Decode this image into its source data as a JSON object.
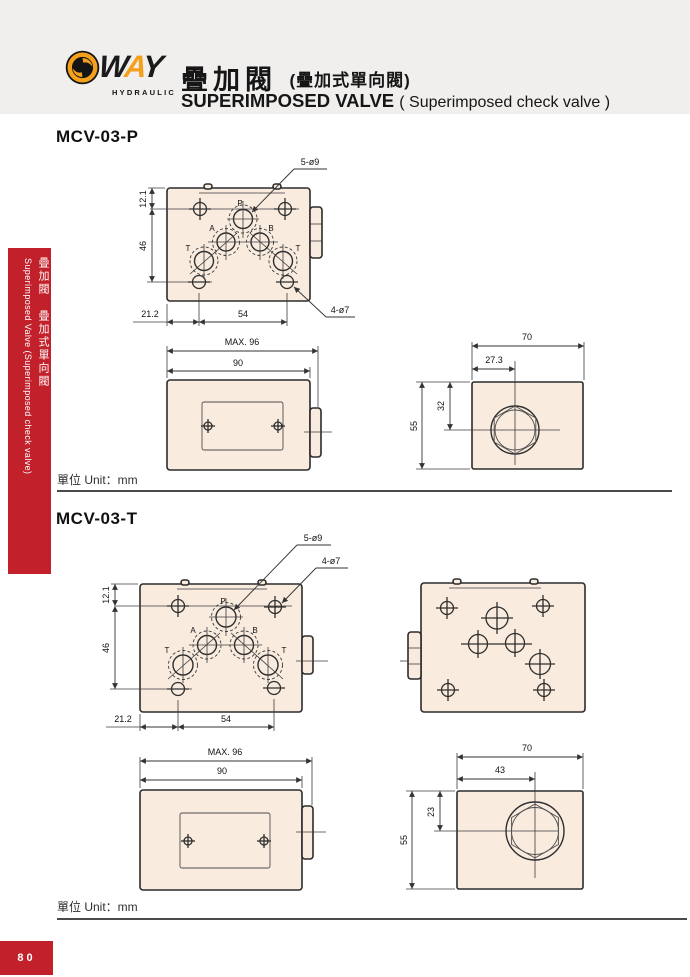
{
  "header": {
    "brand_w": "W",
    "brand_a": "A",
    "brand_y": "Y",
    "brand_sub": "HYDRAULIC",
    "title_cn": "疊加閥",
    "title_cn_note": "(疊加式單向閥)",
    "title_en": "SUPERIMPOSED VALVE",
    "title_en_note": "( Superimposed check valve )"
  },
  "sidebar": {
    "cn": "疊加閥 疊加式單向閥",
    "en": "Superimposed Valve (Superimposed check valve)"
  },
  "page_number": "80",
  "unit_label": "單位 Unit：mm",
  "colors": {
    "accent_red": "#c2202a",
    "logo_orange": "#f5a01b",
    "drawing_fill": "#f9ecdf",
    "header_gray": "#f0efed"
  },
  "mcv03p": {
    "heading": "MCV-03-P",
    "top_view": {
      "callout_5holes": "5-ø9",
      "callout_4holes": "4-ø7",
      "h_121": "12.1",
      "h_46": "46",
      "w_212": "21.2",
      "w_54": "54",
      "port_p": "P",
      "port_a": "A",
      "port_b": "B",
      "port_t1": "T",
      "port_t2": "T"
    },
    "front_view": {
      "w_max": "MAX. 96",
      "w_90": "90"
    },
    "side_view": {
      "w_70": "70",
      "w_273": "27.3",
      "h_55": "55",
      "h_32": "32"
    }
  },
  "mcv03t": {
    "heading": "MCV-03-T",
    "top_view": {
      "callout_5holes": "5-ø9",
      "callout_4holes": "4-ø7",
      "h_121": "12.1",
      "h_46": "46",
      "w_212": "21.2",
      "w_54": "54",
      "port_p": "P",
      "port_a": "A",
      "port_b": "B",
      "port_t1": "T",
      "port_t2": "T"
    },
    "front_view": {
      "w_max": "MAX. 96",
      "w_90": "90"
    },
    "side_view": {
      "w_70": "70",
      "w_43": "43",
      "h_55": "55",
      "h_23": "23"
    }
  }
}
